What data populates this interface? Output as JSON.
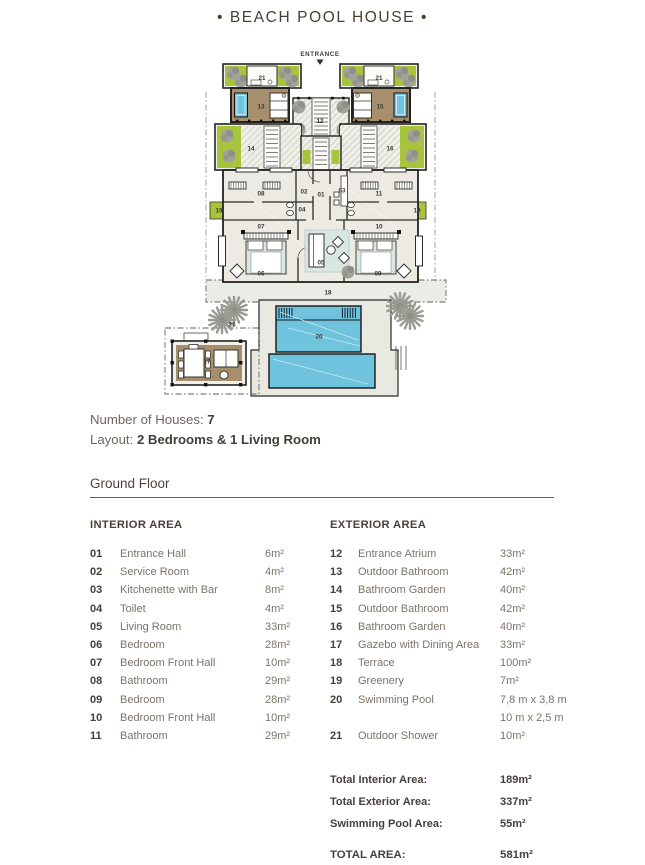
{
  "title": "• BEACH POOL HOUSE •",
  "colors": {
    "greenery": "#a8c43c",
    "pool_blue": "#6fc3dd",
    "wood_brown": "#a78f6e",
    "ink": "#45403a"
  },
  "plan": {
    "entrance_label": "ENTRANCE",
    "room_labels": [
      {
        "t": "21",
        "x": 104,
        "y": 34.5
      },
      {
        "t": "21",
        "x": 221,
        "y": 34.5
      },
      {
        "t": "13",
        "x": 103,
        "y": 63
      },
      {
        "t": "15",
        "x": 222,
        "y": 63
      },
      {
        "t": "12",
        "x": 162,
        "y": 77.5
      },
      {
        "t": "14",
        "x": 93,
        "y": 105
      },
      {
        "t": "16",
        "x": 232,
        "y": 105
      },
      {
        "t": "08",
        "x": 103,
        "y": 150
      },
      {
        "t": "02",
        "x": 146,
        "y": 148
      },
      {
        "t": "01",
        "x": 163,
        "y": 151
      },
      {
        "t": "03",
        "x": 184,
        "y": 147
      },
      {
        "t": "11",
        "x": 221,
        "y": 150
      },
      {
        "t": "04",
        "x": 144,
        "y": 166
      },
      {
        "t": "19",
        "x": 61,
        "y": 167
      },
      {
        "t": "19",
        "x": 259,
        "y": 167
      },
      {
        "t": "07",
        "x": 103,
        "y": 183
      },
      {
        "t": "10",
        "x": 221,
        "y": 183
      },
      {
        "t": "05",
        "x": 163,
        "y": 219
      },
      {
        "t": "06",
        "x": 103,
        "y": 230
      },
      {
        "t": "09",
        "x": 220,
        "y": 230
      },
      {
        "t": "18",
        "x": 170,
        "y": 249
      },
      {
        "t": "21",
        "x": 74,
        "y": 281
      },
      {
        "t": "20",
        "x": 161,
        "y": 293
      },
      {
        "t": "17",
        "x": 49,
        "y": 318
      }
    ]
  },
  "info": {
    "houses_label": "Number of Houses: ",
    "houses_value": "7",
    "layout_label": "Layout: ",
    "layout_value": "2 Bedrooms & 1 Living Room"
  },
  "section_title": "Ground Floor",
  "interior": {
    "header": "INTERIOR AREA",
    "rows": [
      {
        "no": "01",
        "name": "Entrance Hall",
        "area": "6m²"
      },
      {
        "no": "02",
        "name": "Service Room",
        "area": "4m²"
      },
      {
        "no": "03",
        "name": "Kitchenette with Bar",
        "area": "8m²"
      },
      {
        "no": "04",
        "name": "Toilet",
        "area": "4m²"
      },
      {
        "no": "05",
        "name": "Living Room",
        "area": "33m²"
      },
      {
        "no": "06",
        "name": "Bedroom",
        "area": "28m²"
      },
      {
        "no": "07",
        "name": "Bedroom Front Hall",
        "area": "10m²"
      },
      {
        "no": "08",
        "name": "Bathroom",
        "area": "29m²"
      },
      {
        "no": "09",
        "name": "Bedroom",
        "area": "28m²"
      },
      {
        "no": "10",
        "name": "Bedroom Front Hall",
        "area": "10m²"
      },
      {
        "no": "11",
        "name": "Bathroom",
        "area": "29m²"
      }
    ]
  },
  "exterior": {
    "header": "EXTERIOR AREA",
    "rows": [
      {
        "no": "12",
        "name": "Entrance Atrium",
        "area": "33m²"
      },
      {
        "no": "13",
        "name": "Outdoor Bathroom",
        "area": "42m²"
      },
      {
        "no": "14",
        "name": "Bathroom Garden",
        "area": "40m²"
      },
      {
        "no": "15",
        "name": "Outdoor Bathroom",
        "area": "42m²"
      },
      {
        "no": "16",
        "name": "Bathroom Garden",
        "area": "40m²"
      },
      {
        "no": "17",
        "name": "Gazebo with Dining Area",
        "area": "33m²"
      },
      {
        "no": "18",
        "name": "Terrace",
        "area": "100m²"
      },
      {
        "no": "19",
        "name": "Greenery",
        "area": "7m²"
      },
      {
        "no": "20",
        "name": "Swimming Pool",
        "area": "7,8 m x 3,8 m",
        "area2": "10 m x 2,5 m"
      },
      {
        "no": "21",
        "name": "Outdoor Shower",
        "area": "10m²"
      }
    ]
  },
  "totals": {
    "rows": [
      {
        "label": "Total Interior Area:",
        "value": "189m²"
      },
      {
        "label": "Total Exterior Area:",
        "value": "337m²"
      },
      {
        "label": "Swimming Pool Area:",
        "value": "55m²"
      }
    ],
    "total_label": "TOTAL AREA:",
    "total_value": "581m²"
  }
}
